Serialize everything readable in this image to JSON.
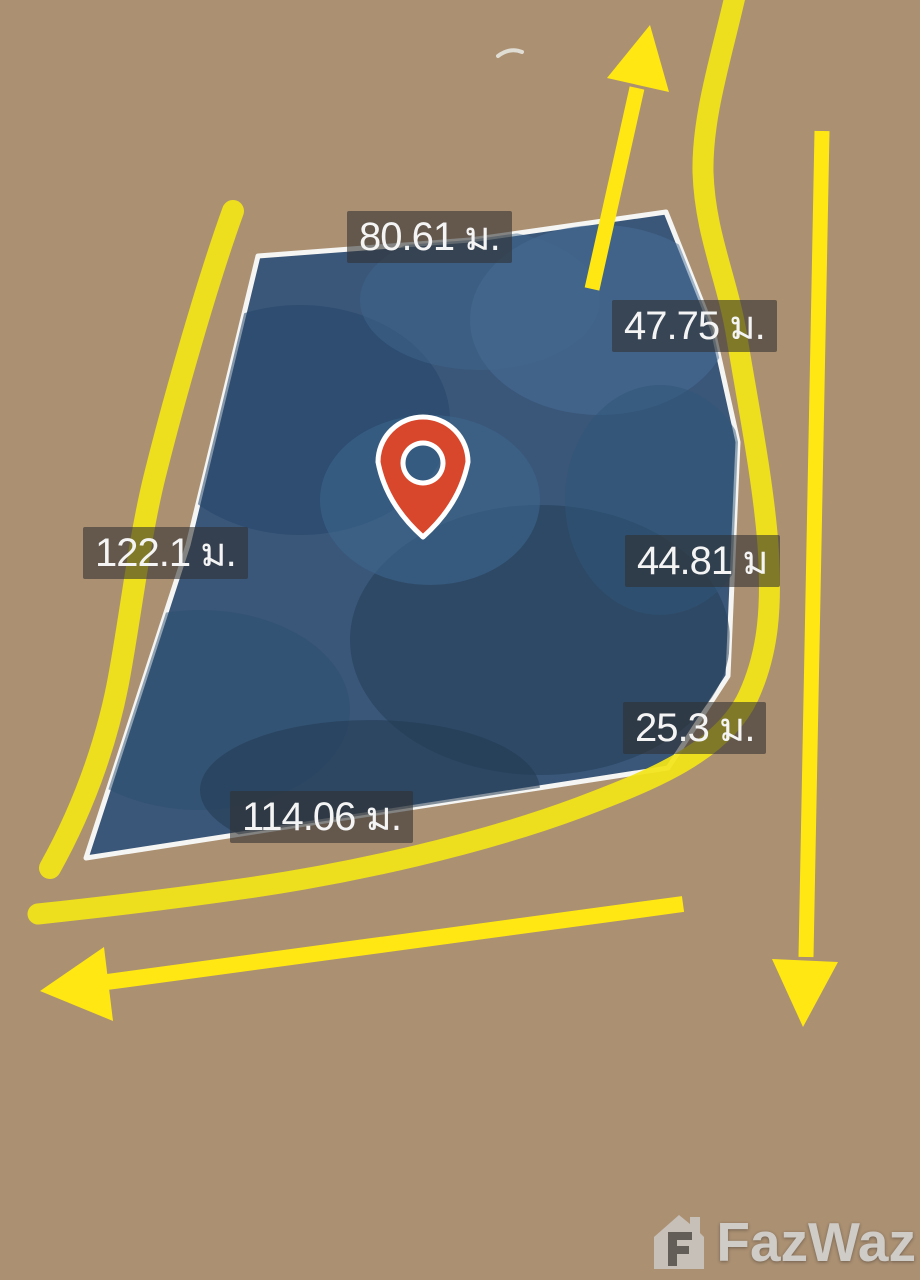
{
  "map": {
    "type": "satellite-land-plot",
    "plot": {
      "fill_color": "#30527a",
      "border_color": "#f5f5f3",
      "measurements": {
        "top": "80.61 ม.",
        "upper_right": "47.75 ม.",
        "left": "122.1 ม.",
        "right": "44.81 ม",
        "lower_right": "25.3 ม.",
        "bottom": "114.06 ม."
      }
    },
    "marker": "red-location-pin",
    "marker_color": "#d8472b",
    "annotation_color": "#f2e418",
    "arrows": [
      "up-top-center",
      "down-right-side",
      "left-bottom"
    ]
  },
  "watermark": {
    "brand": "FazWaz"
  }
}
